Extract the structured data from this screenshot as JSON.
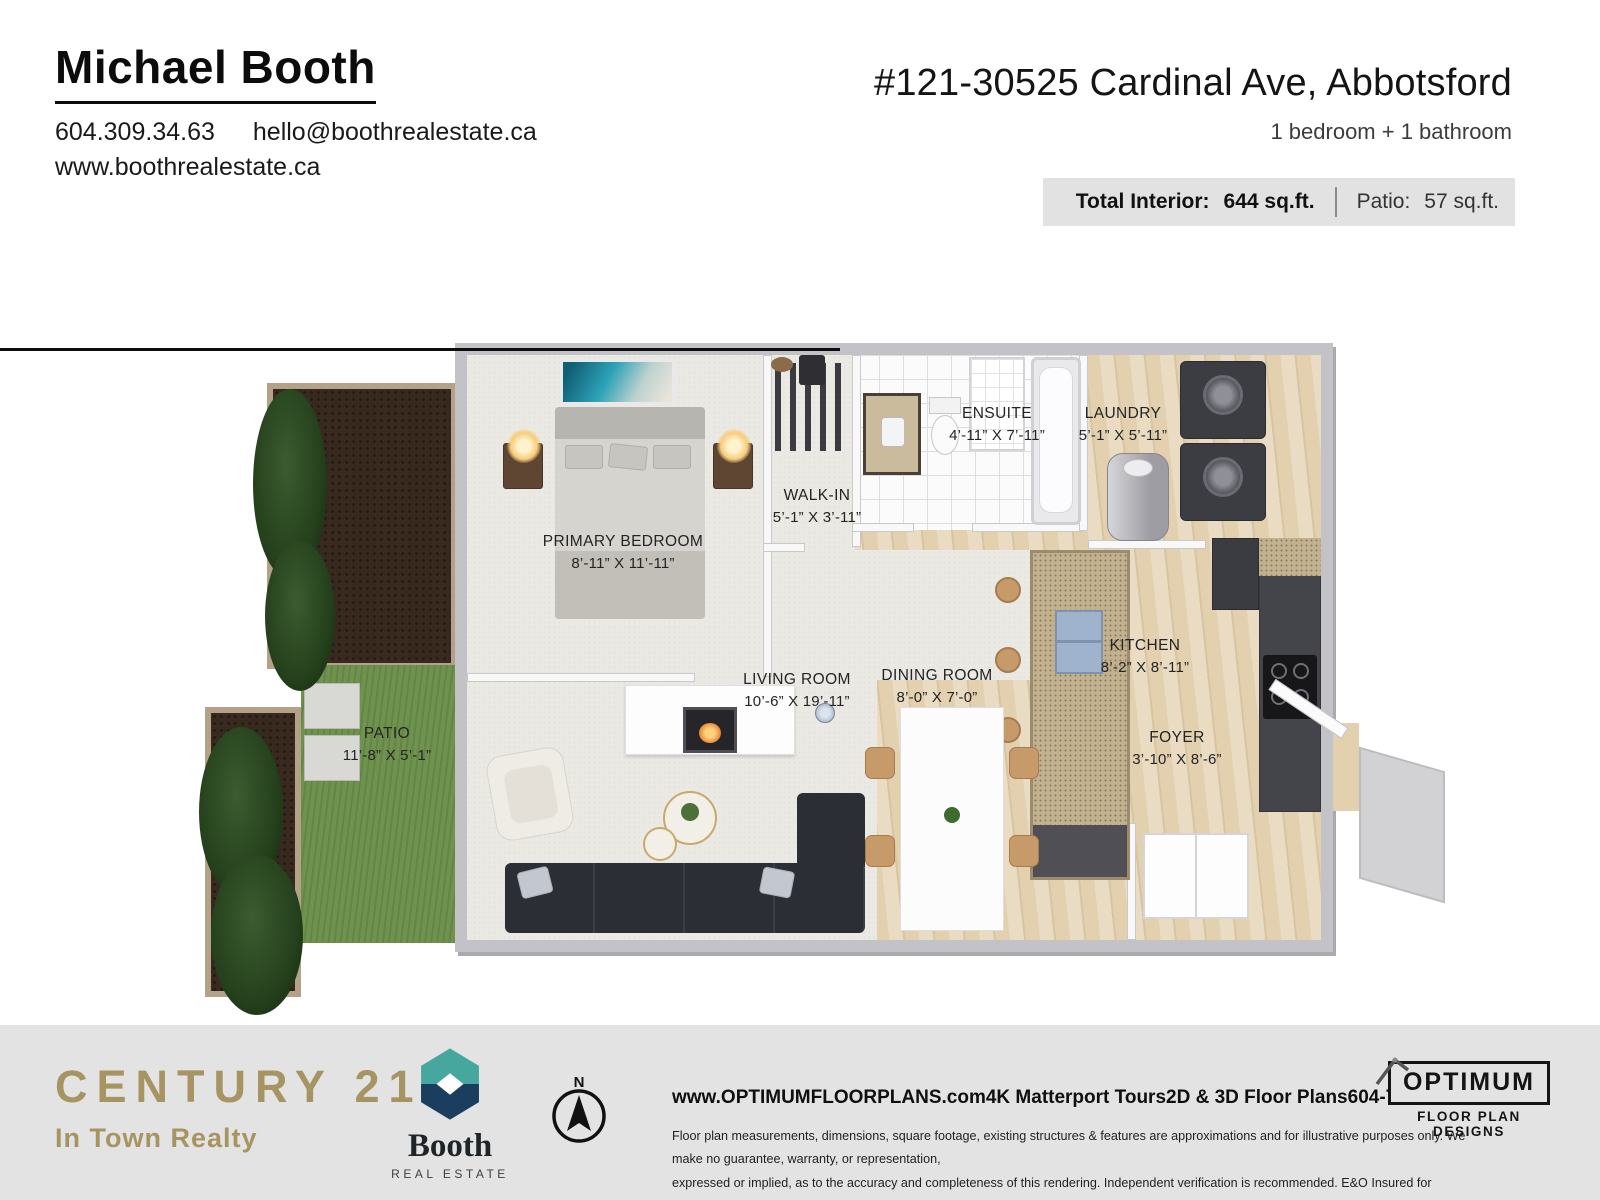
{
  "header": {
    "agent_name": "Michael Booth",
    "phone": "604.309.34.63",
    "email": "hello@boothrealestate.ca",
    "website": "www.boothrealestate.ca",
    "address": "#121-30525 Cardinal Ave, Abbotsford",
    "beds_baths": "1 bedroom + 1 bathroom",
    "total_interior_label": "Total Interior:",
    "total_interior_value": "644 sq.ft.",
    "patio_label": "Patio:",
    "patio_value": "57 sq.ft."
  },
  "floor_plan": {
    "rooms": [
      {
        "name": "PRIMARY BEDROOM",
        "dims": "8’-11” X 11’-11”"
      },
      {
        "name": "WALK-IN",
        "dims": "5’-1” X 3’-11”"
      },
      {
        "name": "ENSUITE",
        "dims": "4’-11” X 7’-11”"
      },
      {
        "name": "LAUNDRY",
        "dims": "5’-1” X 5’-11”"
      },
      {
        "name": "KITCHEN",
        "dims": "8’-2” X 8’-11”"
      },
      {
        "name": "DINING ROOM",
        "dims": "8’-0” X 7’-0”"
      },
      {
        "name": "LIVING ROOM",
        "dims": "10’-6” X 19’-11”"
      },
      {
        "name": "PATIO",
        "dims": "11’-8” X 5’-1”"
      },
      {
        "name": "FOYER",
        "dims": "3’-10” X 8’-6”"
      }
    ],
    "entrance_label": "ENTRANCE",
    "compass_label": "N"
  },
  "footer": {
    "century21_name": "CENTURY 21.",
    "century21_reg": "®",
    "century21_sub": "In Town Realty",
    "booth_name": "Booth",
    "booth_sub": "REAL ESTATE",
    "optimum_web": "www.OPTIMUMFLOORPLANS.com",
    "tours": "4K Matterport Tours",
    "plans": "2D & 3D Floor Plans",
    "phone": "604-729-5033",
    "disclaimer_line1": "Floor plan measurements, dimensions, square footage, existing structures & features are approximations and for illustrative purposes only. We make no guarantee, warranty, or representation,",
    "disclaimer_line2": "expressed or implied, as to the accuracy and completeness of this rendering. Independent verification is recommended. E&O Insured for $1,000,000",
    "optimum_title": "OPTIMUM",
    "optimum_sub": "FLOOR PLAN DESIGNS"
  },
  "icons": {
    "compass": "circle-with-north-arrow",
    "booth_logo": "hexagon-with-white-diamond",
    "optimum_roof": "roof-outline"
  },
  "colors": {
    "century21_gold": "#a79463",
    "booth_teal": "#45a79e",
    "booth_navy": "#1c3e5e",
    "art_teal": "#2fa3b8",
    "grass_green": "#70924f",
    "soil_brown": "#38291e",
    "wood_floor": "#e2d0af",
    "cabinet_charcoal": "#44444b",
    "wall_gray": "#c3c3c7",
    "stats_bar_gray": "#e2e2e2",
    "footer_gray": "#e3e3e3"
  }
}
